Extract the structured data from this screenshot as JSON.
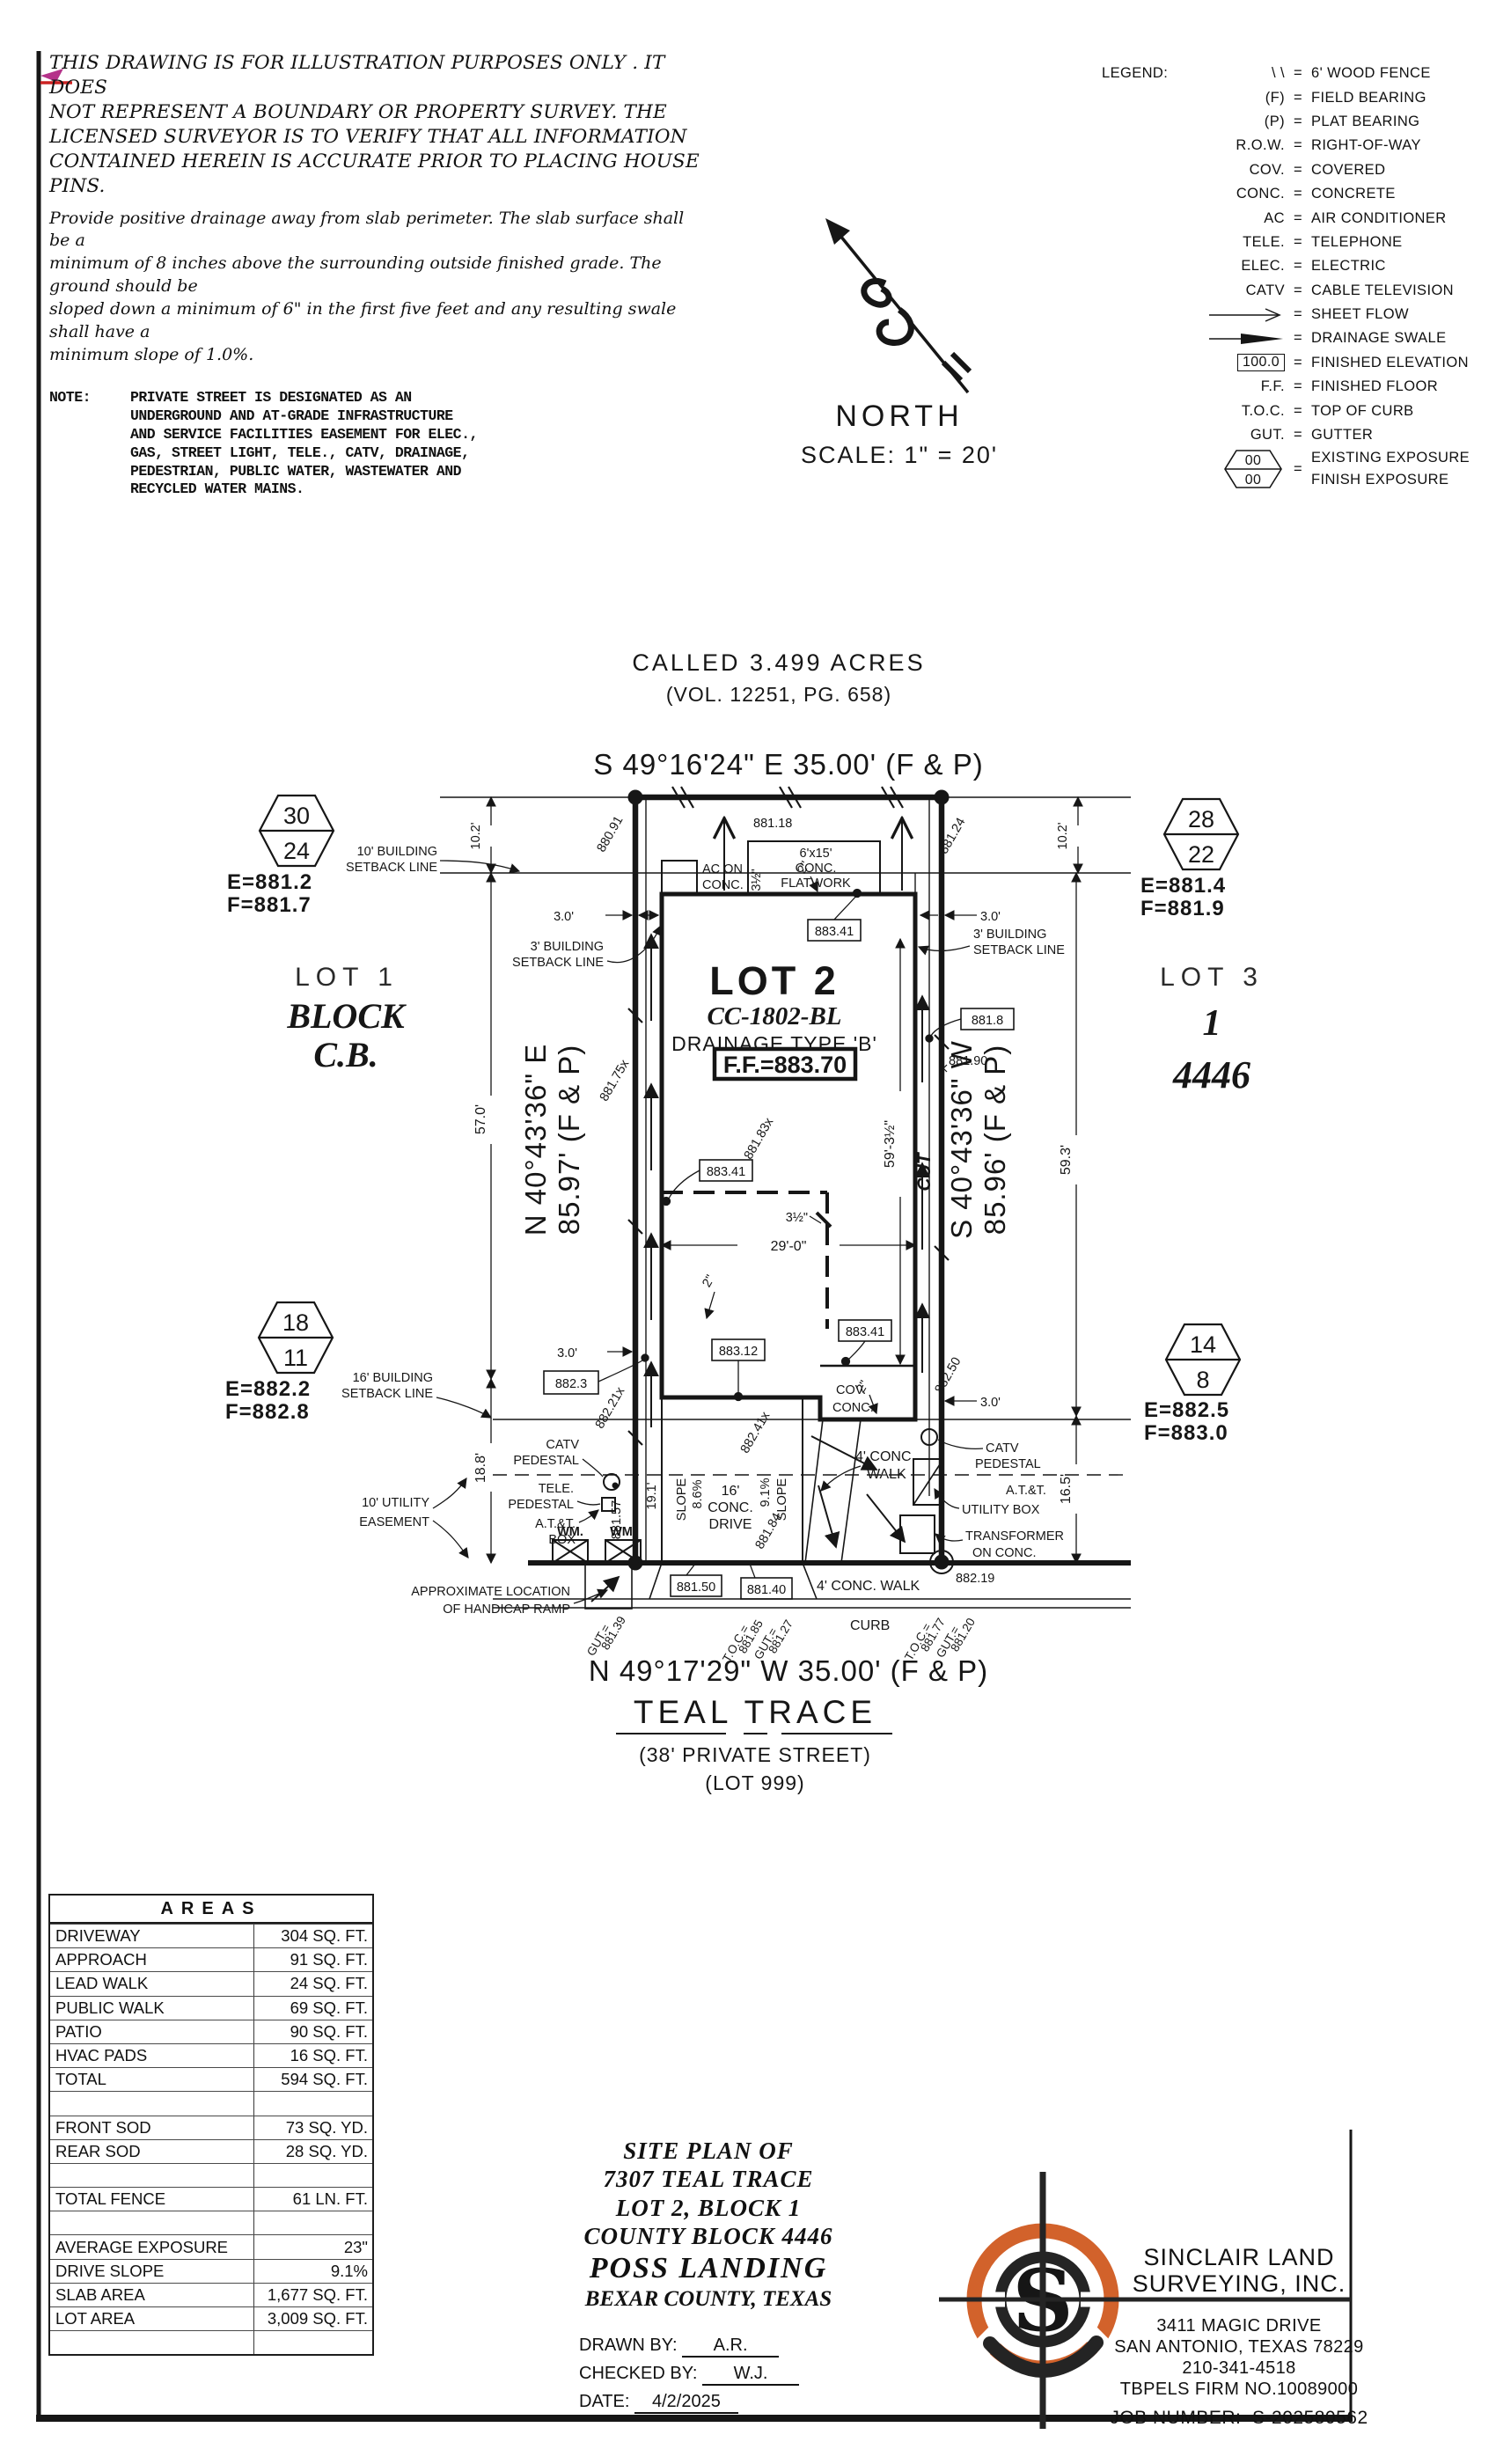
{
  "disclaimer": {
    "lines": [
      "THIS DRAWING IS FOR ILLUSTRATION PURPOSES ONLY . IT DOES",
      "NOT REPRESENT A BOUNDARY OR PROPERTY SURVEY. THE",
      "LICENSED SURVEYOR IS TO VERIFY THAT ALL INFORMATION",
      "CONTAINED HEREIN IS ACCURATE PRIOR TO PLACING HOUSE PINS."
    ],
    "drainage": [
      "Provide positive drainage away from slab perimeter. The slab surface shall be a",
      "minimum of 8 inches above the surrounding outside finished grade. The ground should be",
      "sloped down a minimum of 6\" in the first five feet and any resulting swale shall have a",
      "minimum slope of 1.0%."
    ],
    "note_label": "NOTE:",
    "note_lines": [
      "PRIVATE STREET IS DESIGNATED AS AN",
      "UNDERGROUND AND AT-GRADE INFRASTRUCTURE",
      "AND SERVICE FACILITIES EASEMENT FOR ELEC.,",
      "GAS, STREET LIGHT, TELE., CATV, DRAINAGE,",
      "PEDESTRIAN, PUBLIC WATER, WASTEWATER AND",
      "RECYCLED WATER MAINS."
    ]
  },
  "legend": {
    "title": "LEGEND:",
    "rows": [
      {
        "abbr": "\\ \\",
        "desc": "6' WOOD FENCE"
      },
      {
        "abbr": "(F)",
        "desc": "FIELD BEARING"
      },
      {
        "abbr": "(P)",
        "desc": "PLAT BEARING"
      },
      {
        "abbr": "R.O.W.",
        "desc": "RIGHT-OF-WAY"
      },
      {
        "abbr": "COV.",
        "desc": "COVERED"
      },
      {
        "abbr": "CONC.",
        "desc": "CONCRETE"
      },
      {
        "abbr": "AC",
        "desc": "AIR CONDITIONER"
      },
      {
        "abbr": "TELE.",
        "desc": "TELEPHONE"
      },
      {
        "abbr": "ELEC.",
        "desc": "ELECTRIC"
      },
      {
        "abbr": "CATV",
        "desc": "CABLE TELEVISION"
      },
      {
        "abbr": "",
        "desc": "SHEET FLOW"
      },
      {
        "abbr": "",
        "desc": "DRAINAGE SWALE"
      },
      {
        "abbr": "100.0",
        "desc": "FINISHED ELEVATION"
      },
      {
        "abbr": "F.F.",
        "desc": "FINISHED FLOOR"
      },
      {
        "abbr": "T.O.C.",
        "desc": "TOP OF CURB"
      },
      {
        "abbr": "GUT.",
        "desc": "GUTTER"
      },
      {
        "abbr": "00",
        "abbr2": "00",
        "desc": "EXISTING EXPOSURE",
        "desc2": "FINISH EXPOSURE"
      }
    ]
  },
  "north": {
    "label": "NORTH",
    "scale": "SCALE: 1\" = 20'"
  },
  "plan": {
    "header": {
      "called": "CALLED 3.499 ACRES",
      "vol": "(VOL. 12251, PG. 658)",
      "bearing_top": "S 49°16'24\" E 35.00' (F & P)"
    },
    "street": {
      "bearing_bottom": "N 49°17'29\" W 35.00' (F & P)",
      "name": "TEAL TRACE",
      "private": "(38' PRIVATE STREET)",
      "lot999": "(LOT 999)"
    },
    "west": {
      "lot": "LOT 1",
      "block": "BLOCK",
      "cb": "C.B."
    },
    "east": {
      "lot": "LOT 3",
      "one": "1",
      "block": "4446"
    },
    "house": {
      "lot2": "LOT 2",
      "cc": "CC-1802-BL",
      "drainage": "DRAINAGE TYPE 'B'",
      "ff": "F.F.=883.70"
    },
    "hexagons": {
      "nw": {
        "top": "30",
        "bottom": "24",
        "e": "E=881.2",
        "f": "F=881.7"
      },
      "ne": {
        "top": "28",
        "bottom": "22",
        "e": "E=881.4",
        "f": "F=881.9"
      },
      "sw": {
        "top": "18",
        "bottom": "11",
        "e": "E=882.2",
        "f": "F=882.8"
      },
      "se": {
        "top": "14",
        "bottom": "8",
        "e": "E=882.5",
        "f": "F=883.0"
      }
    },
    "labels": {
      "setback10": [
        "10' BUILDING",
        "SETBACK LINE"
      ],
      "setback3": [
        "3' BUILDING",
        "SETBACK LINE"
      ],
      "setback16": [
        "16' BUILDING",
        "SETBACK LINE"
      ],
      "utility10": [
        "10' UTILITY",
        "EASEMENT"
      ],
      "ac": [
        "AC ON",
        "CONC."
      ],
      "flatwork": [
        "6'x15'",
        "CONC.",
        "FLATWORK"
      ],
      "cov": [
        "COV.",
        "CONC."
      ],
      "drive": [
        "16'",
        "CONC.",
        "DRIVE"
      ],
      "walk4": [
        "4' CONC.",
        "WALK"
      ],
      "walk4b": "4' CONC. WALK",
      "curb": "CURB",
      "handicap": [
        "APPROXIMATE LOCATION",
        "OF HANDICAP RAMP"
      ],
      "catv_ped": [
        "CATV",
        "PEDESTAL"
      ],
      "tele_ped": [
        "TELE.",
        "PEDESTAL"
      ],
      "att_box": [
        "A.T.&T.",
        "BOX"
      ],
      "att_utility": [
        "A.T.&T.",
        "UTILITY BOX"
      ],
      "transformer": [
        "TRANSFORMER",
        "ON CONC."
      ],
      "wm": "WM.",
      "cut": "CUT",
      "slope": "SLOPE",
      "slope_left_pct": "8.6%",
      "slope_right_pct": "9.1%"
    },
    "dims": {
      "d10_2": "10.2'",
      "d57": "57.0'",
      "d59_3": "59.3'",
      "d18_8": "18.8'",
      "d16_5": "16.5'",
      "d19_1": "19.1'",
      "d3_0": "3.0'",
      "d29_0": "29'-0\"",
      "d59_3h": "59'-3½\"",
      "d3_5": "3½\"",
      "d2": "2\""
    },
    "bearings": {
      "west1": "N 40°43'36\" E",
      "west2": "85.97' (F & P)",
      "east1": "S 40°43'36\" W",
      "east2": "85.96' (F & P)"
    },
    "elevations": {
      "e880_91": "880.91",
      "e881_18": "881.18",
      "e881_24": "881.24",
      "e881_75": "881.75x",
      "e881_83": "881.83x",
      "e881_8": "881.8",
      "e881_90": "881.90",
      "e882_50": "882.50",
      "e882_21": "882.21x",
      "e882_3": "882.3",
      "e882_19": "882.19",
      "e881_57": "881.57",
      "e881_84": "881.84",
      "e882_41": "882.41x",
      "e883_41": "883.41",
      "e883_12": "883.12",
      "e881_50": "881.50",
      "e881_40": "881.40",
      "toc": "T.O.C.=",
      "gut": "GUT.=",
      "v_toc_mid": "881.85",
      "v_gut_mid": "881.27",
      "v_gut_left": "881.39",
      "v_toc_right": "881.77",
      "v_gut_right": "881.20"
    }
  },
  "areas_table": {
    "title": "AREAS",
    "rows": [
      {
        "label": "DRIVEWAY",
        "value": "304 SQ. FT."
      },
      {
        "label": "APPROACH",
        "value": "91 SQ. FT."
      },
      {
        "label": "LEAD WALK",
        "value": "24 SQ. FT."
      },
      {
        "label": "PUBLIC WALK",
        "value": "69 SQ. FT."
      },
      {
        "label": "PATIO",
        "value": "90 SQ. FT."
      },
      {
        "label": "HVAC PADS",
        "value": "16 SQ. FT."
      },
      {
        "label": "TOTAL",
        "value": "594 SQ. FT."
      },
      {
        "label": "",
        "value": ""
      },
      {
        "label": "FRONT SOD",
        "value": "73 SQ. YD."
      },
      {
        "label": "REAR SOD",
        "value": "28 SQ. YD."
      },
      {
        "label": "",
        "value": ""
      },
      {
        "label": "TOTAL FENCE",
        "value": "61 LN. FT."
      },
      {
        "label": "",
        "value": ""
      },
      {
        "label": "AVERAGE EXPOSURE",
        "value": "23\""
      },
      {
        "label": "DRIVE SLOPE",
        "value": "9.1%"
      },
      {
        "label": "SLAB AREA",
        "value": "1,677 SQ. FT."
      },
      {
        "label": "LOT AREA",
        "value": "3,009 SQ. FT."
      },
      {
        "label": "",
        "value": ""
      }
    ]
  },
  "titleblock": {
    "line1": "SITE PLAN OF",
    "line2": "7307 TEAL TRACE",
    "line3": "LOT 2, BLOCK 1",
    "line4": "COUNTY BLOCK 4446",
    "subdivision": "POSS LANDING",
    "county": "BEXAR COUNTY, TEXAS",
    "drawn_label": "DRAWN BY:",
    "drawn": "A.R.",
    "checked_label": "CHECKED BY:",
    "checked": "W.J.",
    "date_label": "DATE:",
    "date": "4/2/2025"
  },
  "company": {
    "name1": "SINCLAIR LAND",
    "name2": "SURVEYING, INC.",
    "addr1": "3411 MAGIC DRIVE",
    "addr2": "SAN ANTONIO, TEXAS 78229",
    "phone": "210-341-4518",
    "firm": "TBPELS FIRM NO.10089000",
    "job_label": "JOB NUMBER:",
    "job": "S-202580562",
    "logo_letter": "S"
  },
  "colors": {
    "logo_orange": "#d2622b",
    "ink": "#161616",
    "mark_magenta": "#b5338a",
    "mark_red": "#cc2222"
  }
}
